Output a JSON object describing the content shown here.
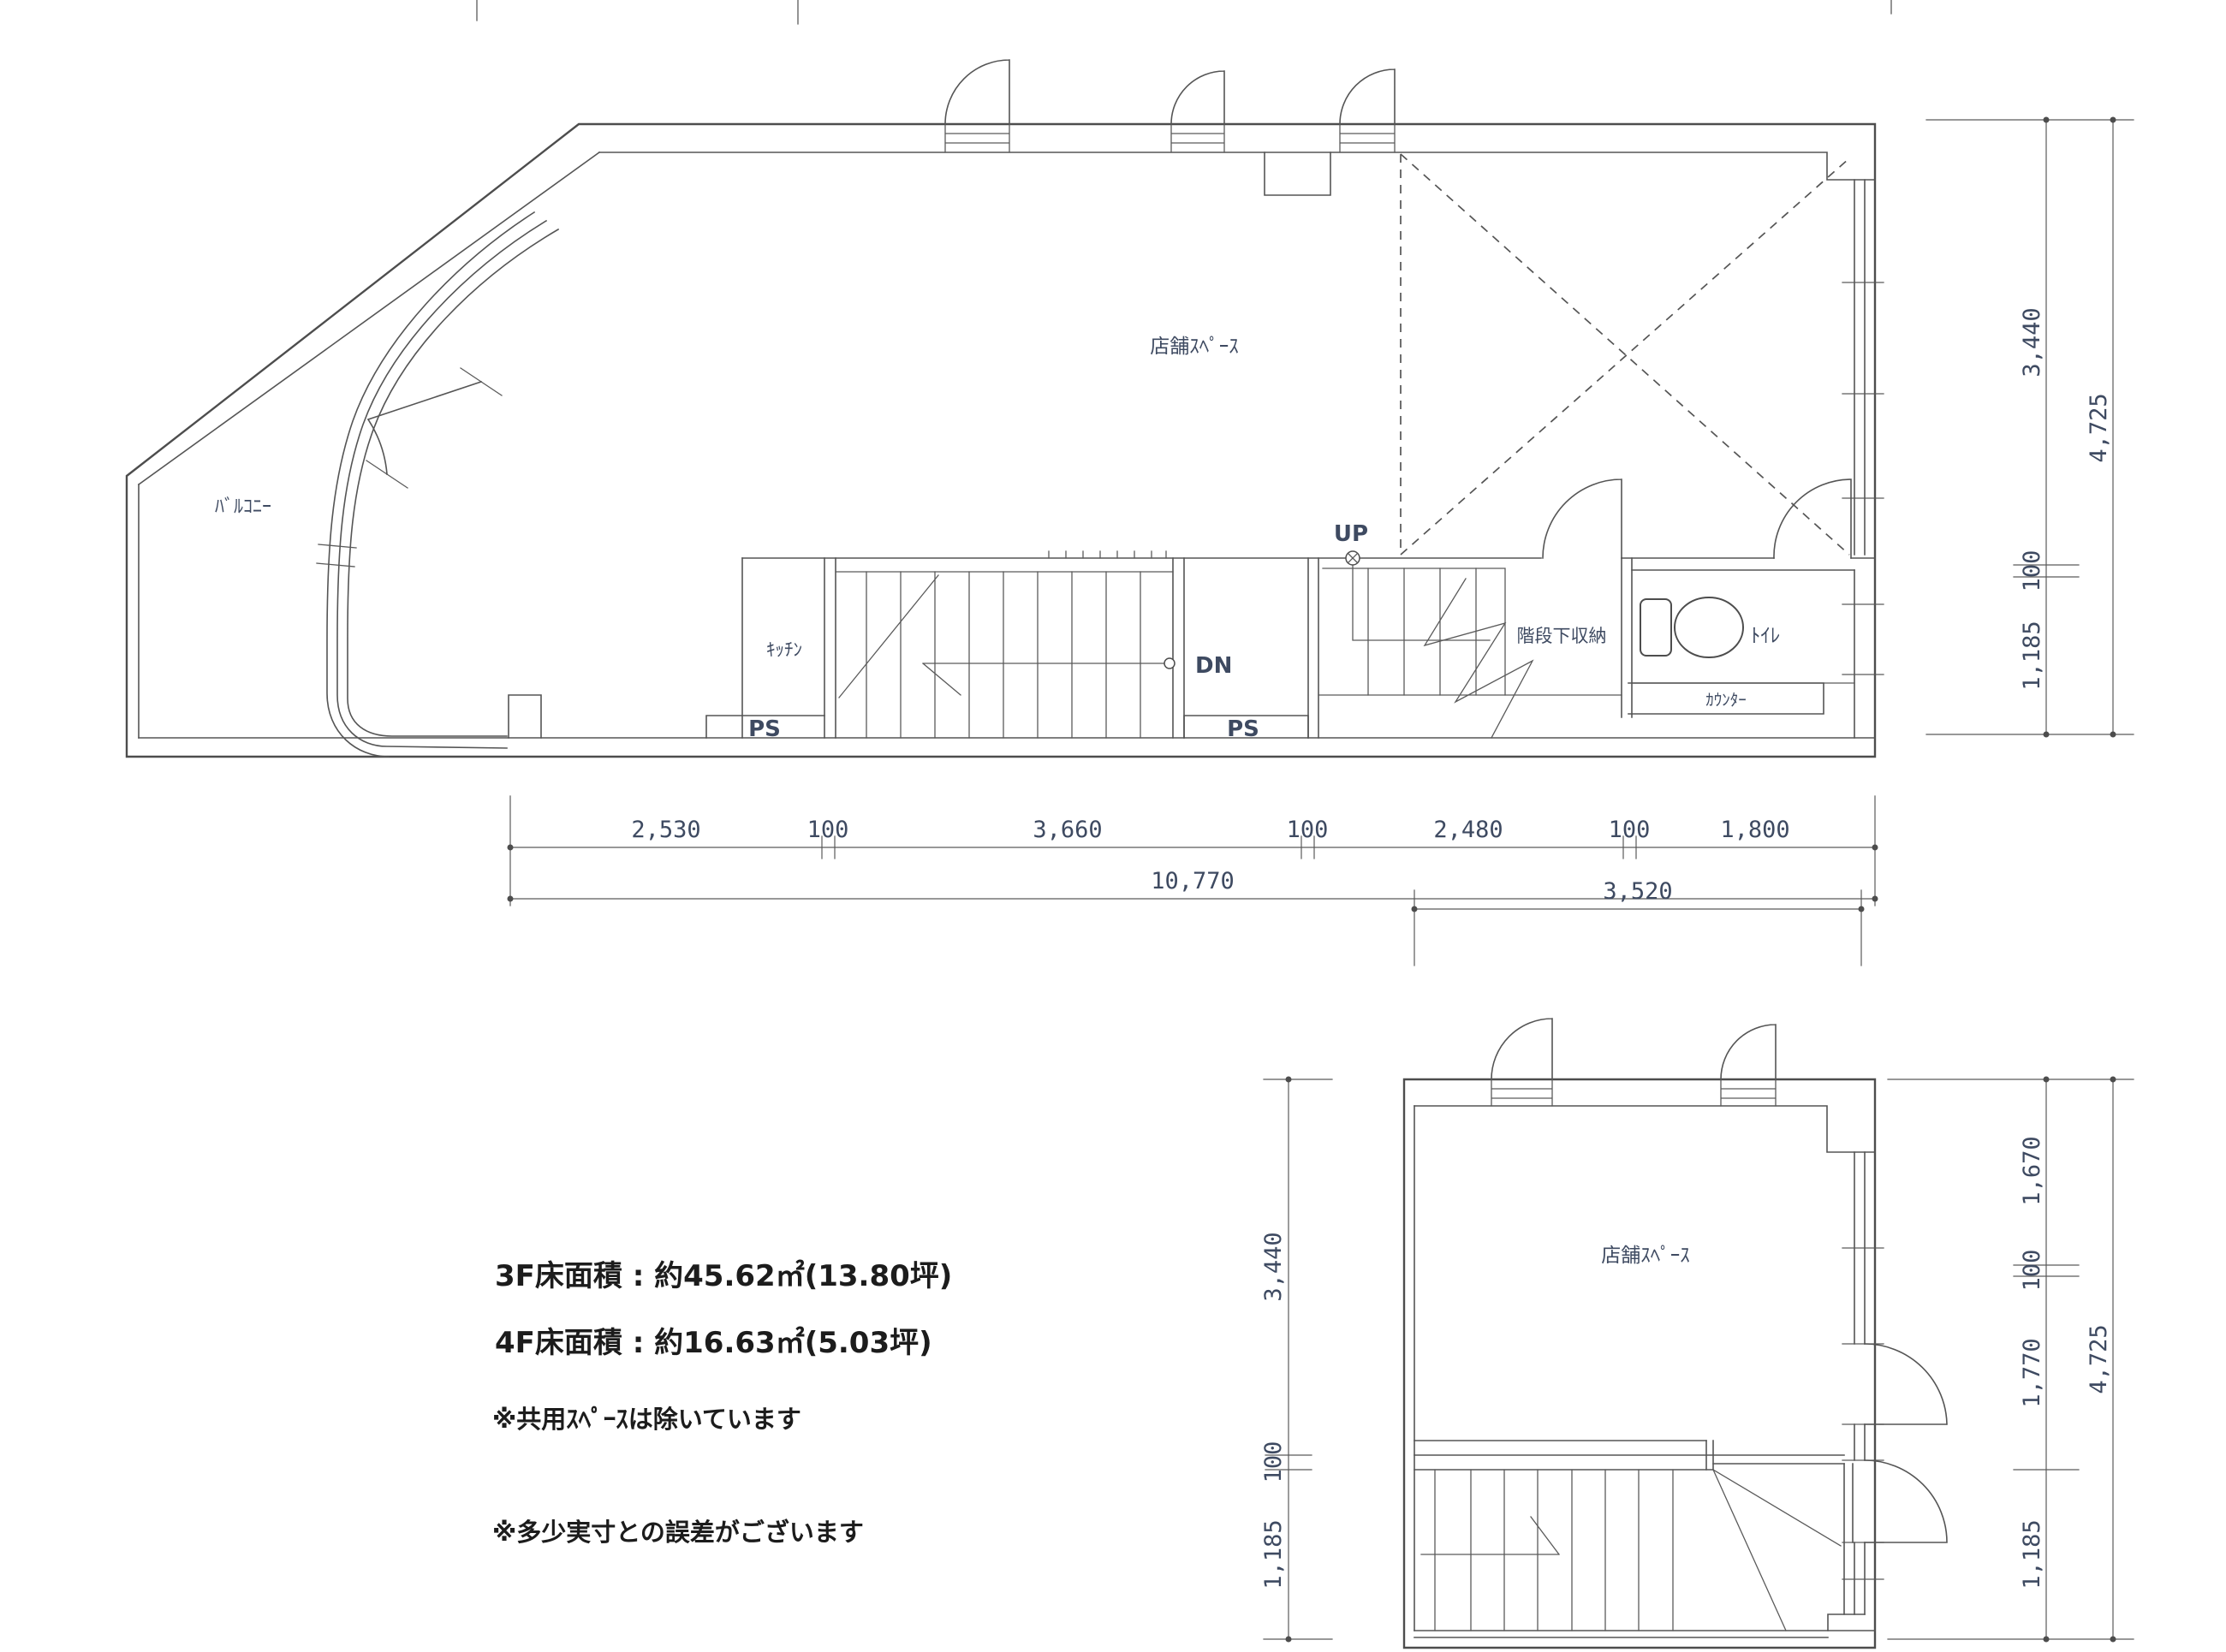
{
  "plan_3f": {
    "labels": {
      "shop": "店舗ｽﾍﾟｰｽ",
      "balcony": "ﾊﾞﾙｺﾆｰ",
      "kitchen": "ｷｯﾁﾝ",
      "toilet": "ﾄｲﾚ",
      "understair_storage": "階段下収納",
      "counter": "ｶｳﾝﾀｰ",
      "ps_left": "PS",
      "ps_right": "PS",
      "up": "UP",
      "down": "DN"
    },
    "dims": {
      "bottom_segments": [
        "2,530",
        "100",
        "3,660",
        "100",
        "2,480",
        "100",
        "1,800"
      ],
      "bottom_total": "10,770",
      "right_segments": [
        "3,440",
        "100",
        "1,185"
      ],
      "right_total": "4,725"
    }
  },
  "plan_4f": {
    "labels": {
      "shop": "店舗ｽﾍﾟｰｽ"
    },
    "dims": {
      "top_total": "3,520",
      "left_segments": [
        "3,440",
        "100",
        "1,185"
      ],
      "right_segments": [
        "1,670",
        "100",
        "1,770",
        "1,185"
      ],
      "right_total": "4,725"
    }
  },
  "notes": {
    "area_3f": "3F床面積 : 約45.62㎡(13.80坪)",
    "area_4f": "4F床面積 : 約16.63㎡(5.03坪)",
    "note_shared": "※共用ｽﾍﾟｰｽは除いています",
    "note_tolerance": "※多少実寸との誤差がございます"
  }
}
